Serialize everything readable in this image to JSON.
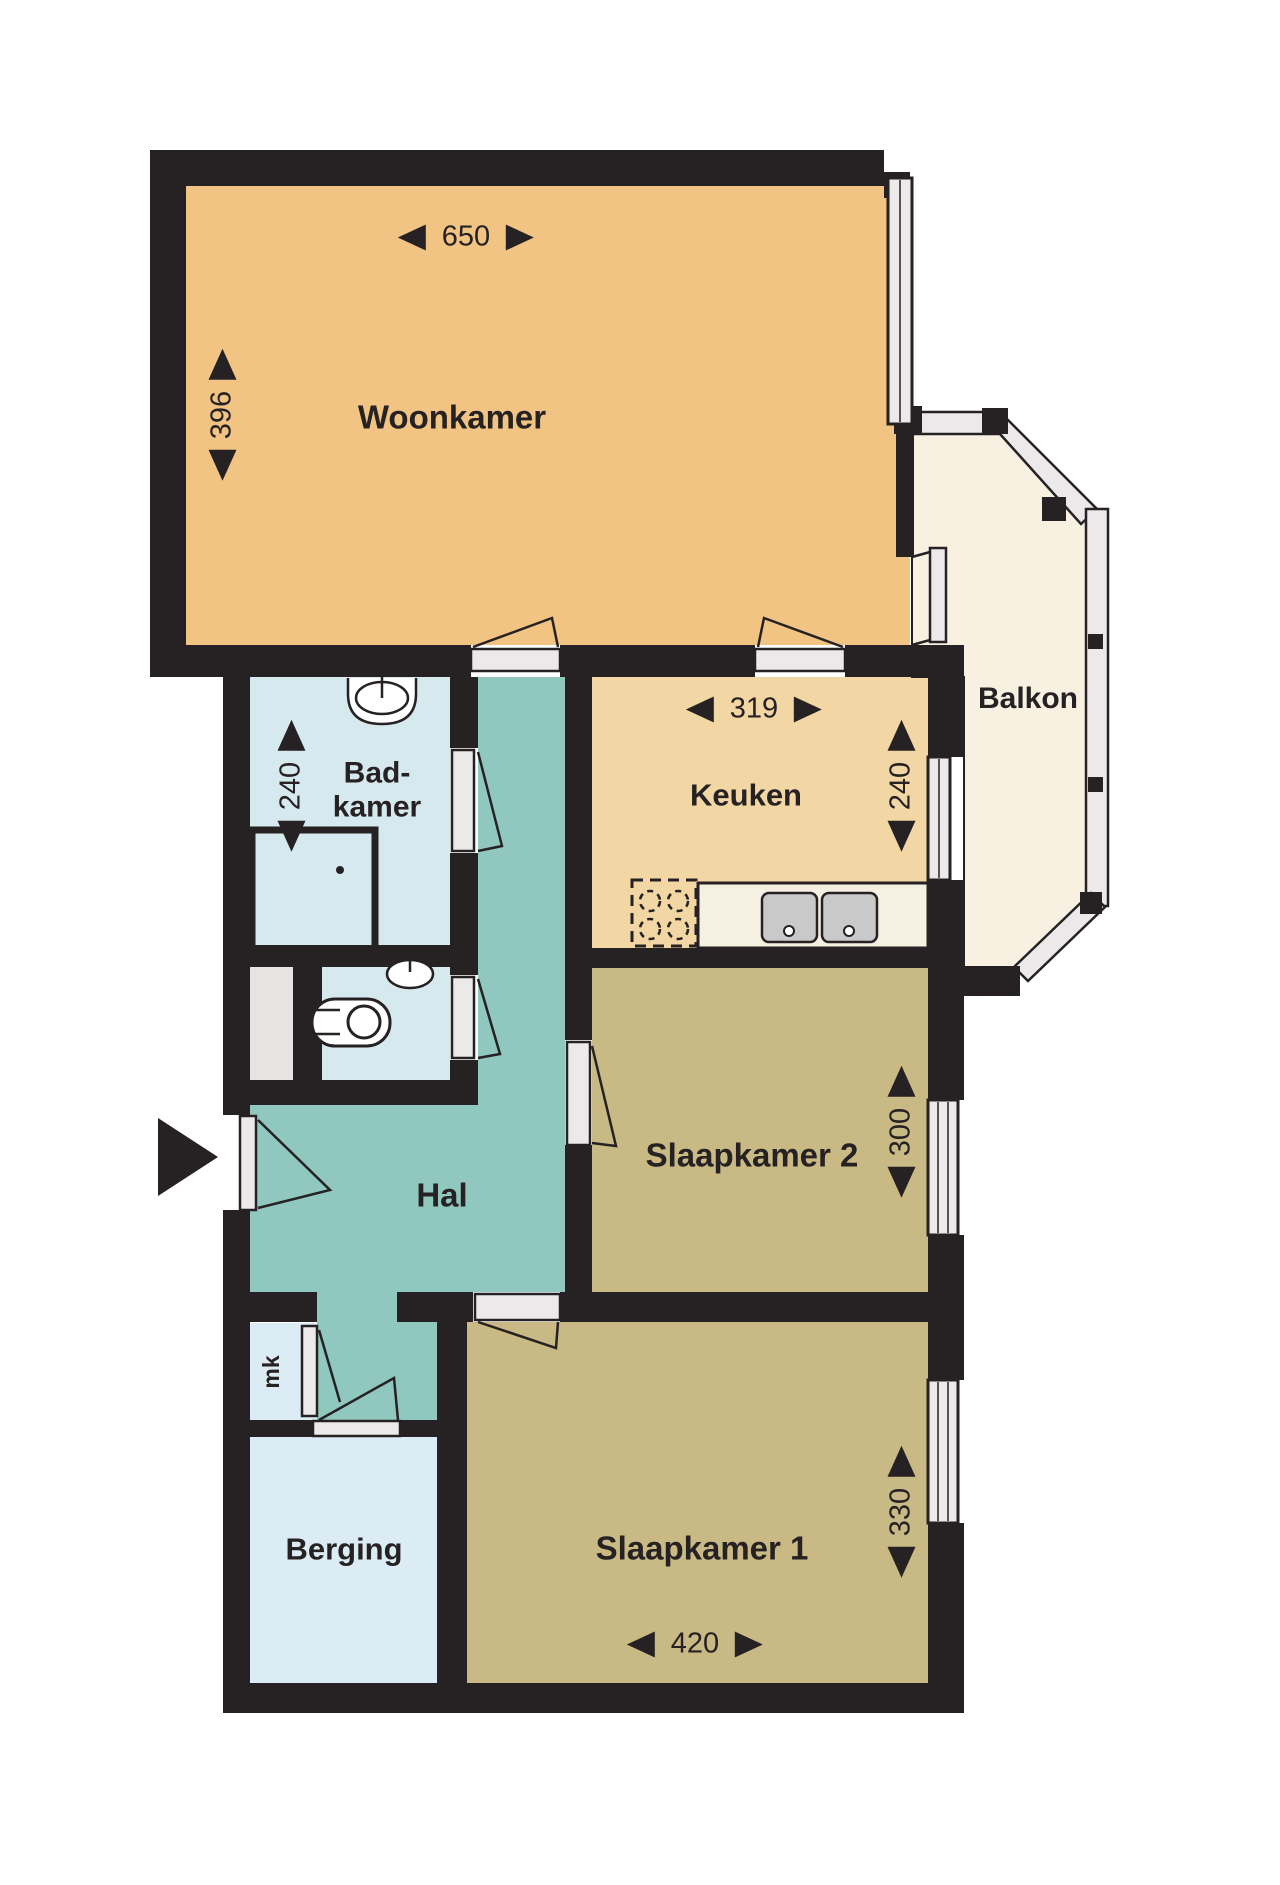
{
  "plan_type": "apartment floor plan",
  "colors": {
    "wall": "#262122",
    "woonkamer": "#f1c483",
    "keuken": "#f2d7a4",
    "slaapkamers": "#c9ba85",
    "hal": "#90c8c0",
    "badkamer_wc": "#d6e9ef",
    "berging_mk": "#dcecf4",
    "balkon": "#f8f1e2",
    "frame_gray": "#ebe9e9"
  },
  "rooms": {
    "woonkamer": {
      "label": "Woonkamer",
      "width": "650",
      "depth": "396"
    },
    "keuken": {
      "label": "Keuken",
      "width": "319",
      "depth": "240"
    },
    "badkamer": {
      "label_line1": "Bad-",
      "label_line2": "kamer",
      "depth": "240"
    },
    "balkon": {
      "label": "Balkon"
    },
    "hal": {
      "label": "Hal"
    },
    "slaapkamer2": {
      "label": "Slaapkamer 2",
      "depth": "300"
    },
    "slaapkamer1": {
      "label": "Slaapkamer 1",
      "width": "420",
      "depth": "330"
    },
    "berging": {
      "label": "Berging"
    },
    "meterkast": {
      "label": "mk"
    }
  }
}
